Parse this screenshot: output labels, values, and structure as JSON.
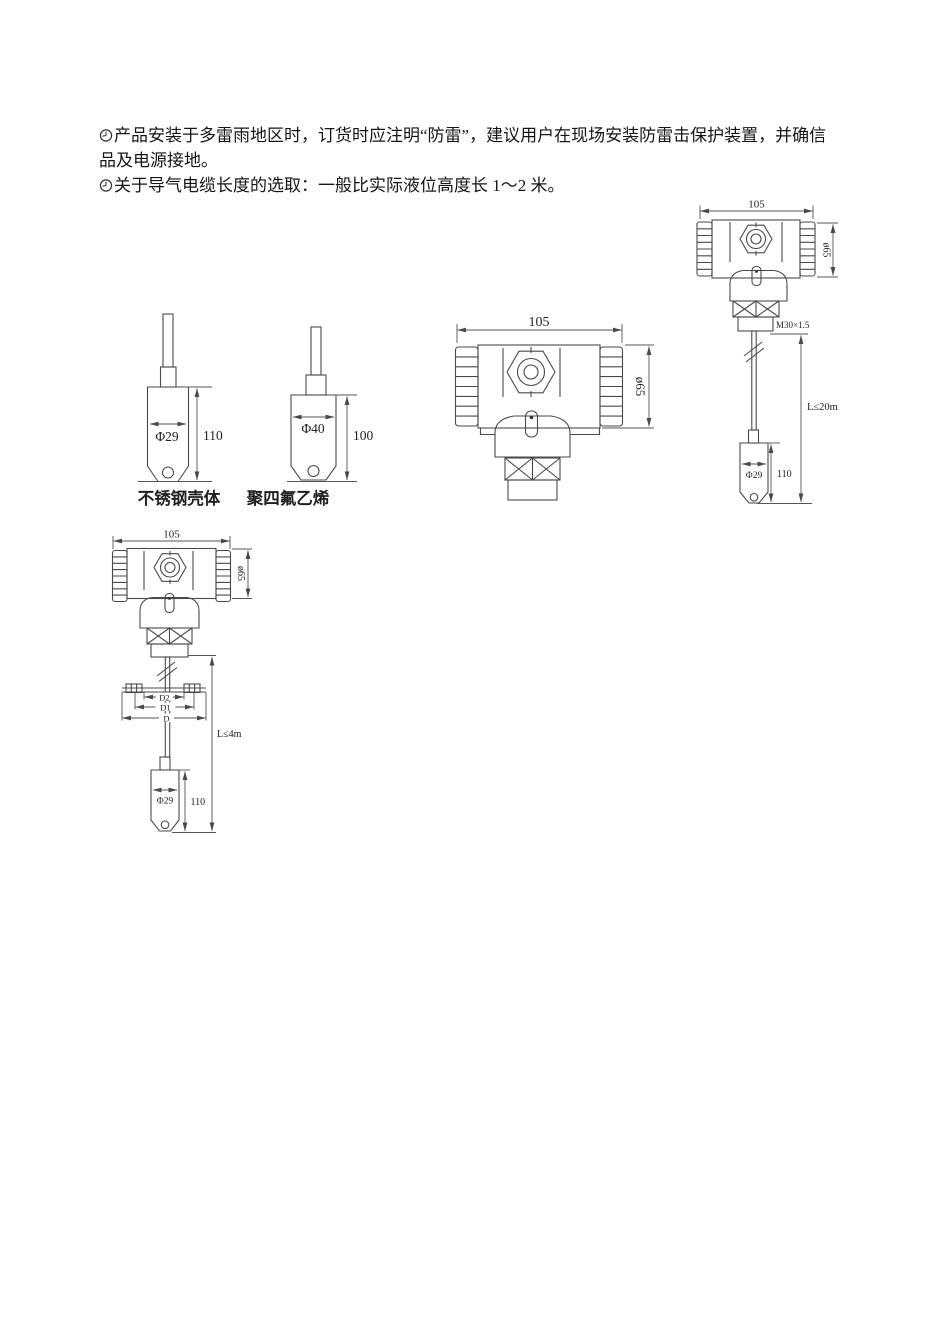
{
  "notes": {
    "line1": "产品安装于多雷雨地区时，订货时应注明“防雷”，建议用户在现场安装防雷击保护装置，并确信",
    "line2": "品及电源接地。",
    "line3": "关于导气电缆长度的选取：一般比实际液位高度长 1～2 米。"
  },
  "probes": {
    "stainless": {
      "diameter": "Φ29",
      "height": "110",
      "label": "不锈钢壳体"
    },
    "ptfe": {
      "diameter": "Φ40",
      "height": "100",
      "label": "聚四氟乙烯"
    }
  },
  "housing": {
    "width": "105",
    "diameter": "ø65"
  },
  "cable_type": {
    "width": "105",
    "diameter": "ø65",
    "thread": "M30×1.5",
    "length_limit": "L≤20m",
    "probe_diameter": "Φ29",
    "probe_height": "110"
  },
  "flange_type": {
    "width": "105",
    "diameter": "ø65",
    "d2": "D2",
    "d1": "D1",
    "d": "D",
    "length_limit": "L≤4m",
    "probe_diameter": "Φ29",
    "probe_height": "110"
  },
  "colors": {
    "background": "#ffffff",
    "ink": "#1f1f1f",
    "line": "#4a4a4a"
  }
}
